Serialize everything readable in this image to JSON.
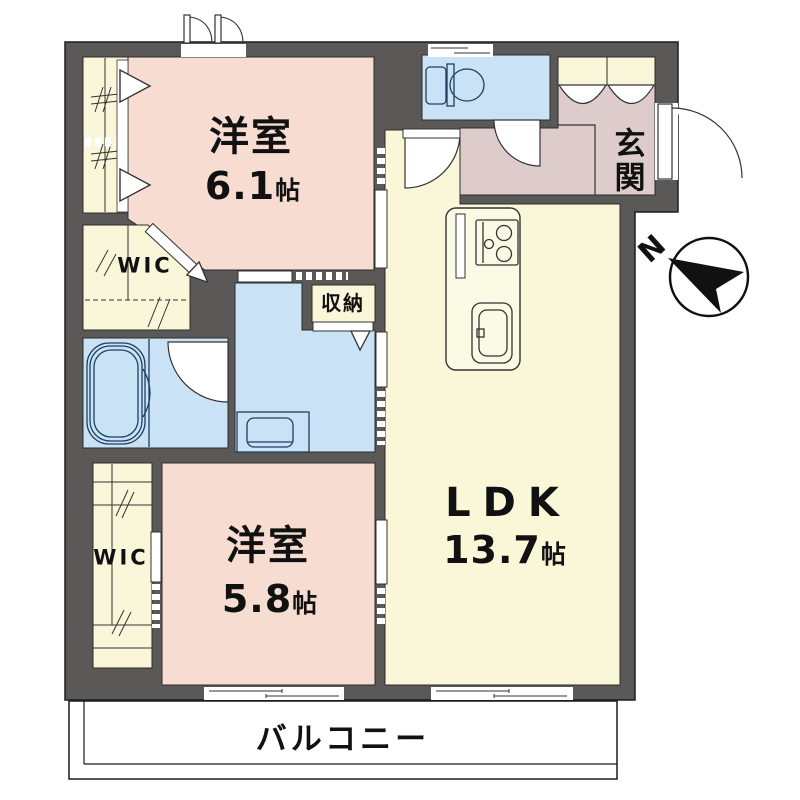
{
  "floorplan": {
    "title": "1LDK+2WIC apartment floor plan",
    "rooms": {
      "bedroom1": {
        "name": "洋室",
        "size": "6.1",
        "unit": "帖"
      },
      "bedroom2": {
        "name": "洋室",
        "size": "5.8",
        "unit": "帖"
      },
      "ldk": {
        "name": "LDK",
        "size": "13.7",
        "unit": "帖"
      },
      "wic1": {
        "label": "WIC"
      },
      "wic2": {
        "label": "WIC"
      },
      "storage": {
        "label": "収納"
      },
      "entrance": {
        "label": "玄関"
      },
      "balcony": {
        "label": "バルコニー"
      }
    },
    "compass": {
      "label": "N"
    },
    "colors": {
      "wall": "#5b5957",
      "room_pink": "#f7dcd2",
      "closet_cream": "#faf6d9",
      "wet_blue": "#c9e2f6",
      "hall_mauve": "#decccd",
      "ldk_yellow": "#f9f7d8",
      "balcony_white": "#ffffff",
      "counter_fill": "#fbfae4",
      "line": "#2e2c2a"
    }
  }
}
